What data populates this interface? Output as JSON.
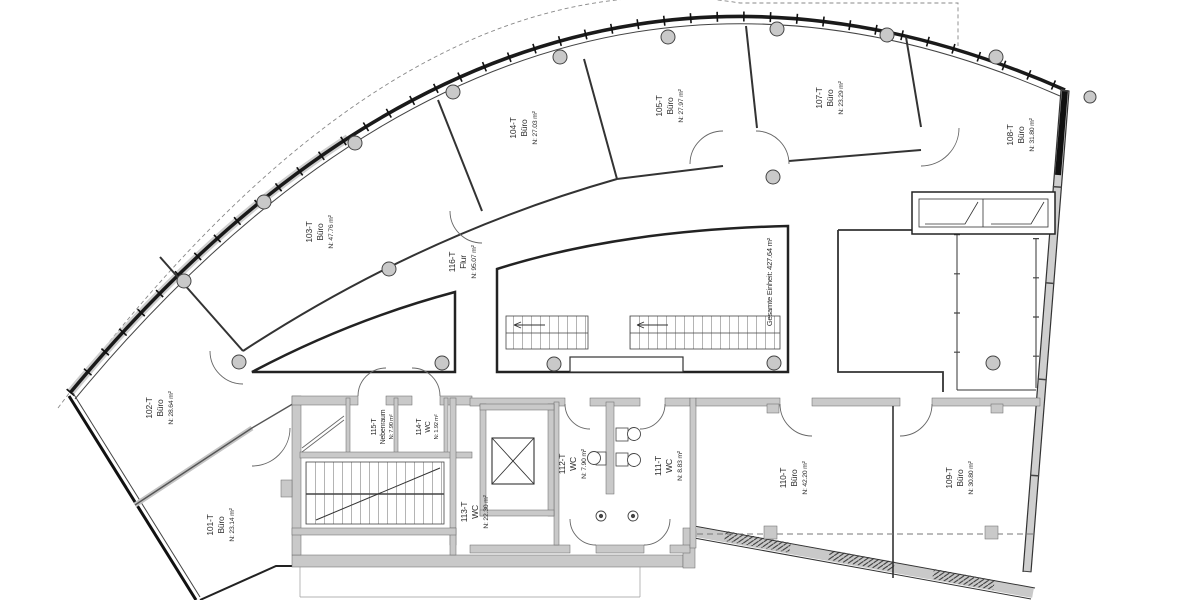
{
  "drawing": {
    "total_area_label": "Gesamte Einheit: 427.64 m²",
    "rooms": [
      {
        "id": "101-T",
        "type": "Büro",
        "area": "N: 23.14 m²"
      },
      {
        "id": "102-T",
        "type": "Büro",
        "area": "N: 28.64 m²"
      },
      {
        "id": "103-T",
        "type": "Büro",
        "area": "N: 47.76 m²"
      },
      {
        "id": "104-T",
        "type": "Büro",
        "area": "N: 27.03 m²"
      },
      {
        "id": "105-T",
        "type": "Büro",
        "area": "N: 27.97 m²"
      },
      {
        "id": "107-T",
        "type": "Büro",
        "area": "N: 23.29 m²"
      },
      {
        "id": "108-T",
        "type": "Büro",
        "area": "N: 31.80 m²"
      },
      {
        "id": "109-T",
        "type": "Büro",
        "area": "N: 30.80 m²"
      },
      {
        "id": "110-T",
        "type": "Büro",
        "area": "N: 42.20 m²"
      },
      {
        "id": "111-T",
        "type": "WC",
        "area": "N: 8.83 m²"
      },
      {
        "id": "112-T",
        "type": "WC",
        "area": "N: 7.90 m²"
      },
      {
        "id": "113-T",
        "type": "WC",
        "area": "N: 22.30 m²"
      },
      {
        "id": "114-T",
        "type": "WC",
        "area": "N: 1.92 m²"
      },
      {
        "id": "115-T",
        "type": "Nebenraum",
        "area": "N: 7.90 m²"
      },
      {
        "id": "116-T",
        "type": "Flur",
        "area": "N: 95.07 m²"
      }
    ]
  }
}
